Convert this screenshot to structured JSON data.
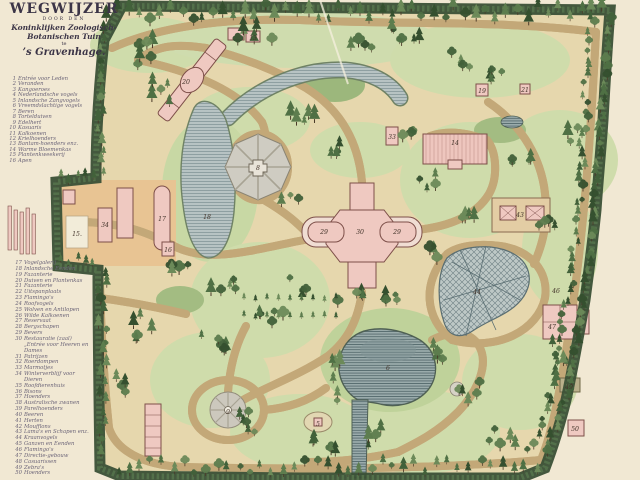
{
  "title": {
    "main": "WEGWIJZER",
    "sub": "DOOR DEN",
    "line3": "Koninklijken Zoologisch-",
    "line4": "Botanischen Tuin",
    "te": "te",
    "city": "’s Gravenhage."
  },
  "legend_top": [
    {
      "num": "1",
      "label": "Entrée voor Leden"
    },
    {
      "num": "2",
      "label": "Veranden"
    },
    {
      "num": "3",
      "label": "Kangoeroes"
    },
    {
      "num": "4",
      "label": "Nederlandsche vogels"
    },
    {
      "num": "5",
      "label": "Inlandsche Zangvogels"
    },
    {
      "num": "6",
      "label": "Vreemdslachtige vogels"
    },
    {
      "num": "7",
      "label": "Beren"
    },
    {
      "num": "8",
      "label": "Tortelduiven"
    },
    {
      "num": "9",
      "label": "Edelhert"
    },
    {
      "num": "10",
      "label": "Kasuaris"
    },
    {
      "num": "11",
      "label": "Kalkoenen"
    },
    {
      "num": "12",
      "label": "Krielhoenders"
    },
    {
      "num": "13",
      "label": "Bantam-hoenders enz."
    },
    {
      "num": "14",
      "label": "Warme Bloemenkas"
    },
    {
      "num": "15",
      "label": "Plantenkweekerij"
    },
    {
      "num": "16",
      "label": "Apen"
    }
  ],
  "legend_bottom": [
    {
      "num": "17",
      "label": "Vogelgalerij"
    },
    {
      "num": "18",
      "label": "Inlandsche Eenden"
    },
    {
      "num": "19",
      "label": "Fazanterie"
    },
    {
      "num": "20",
      "label": "Duiven en Plantenkas"
    },
    {
      "num": "21",
      "label": "Fazanterie"
    },
    {
      "num": "22",
      "label": "Uitspanplaats"
    },
    {
      "num": "23",
      "label": "Flamingo's"
    },
    {
      "num": "24",
      "label": "Roofvogels"
    },
    {
      "num": "25",
      "label": "Wolven en Antilopen"
    },
    {
      "num": "26",
      "label": "Wilde Kalkoenen"
    },
    {
      "num": "27",
      "label": "Reservaat"
    },
    {
      "num": "28",
      "label": "Bergschapen"
    },
    {
      "num": "29",
      "label": "Bevers"
    },
    {
      "num": "30",
      "label": "Restauratie (zaal) „Entrée voor Heeren en Dames"
    },
    {
      "num": "31",
      "label": "Patrijzen"
    },
    {
      "num": "32",
      "label": "Roerdompen"
    },
    {
      "num": "33",
      "label": "Marmotjes"
    },
    {
      "num": "34",
      "label": "Winterverblijf voor Dieren"
    },
    {
      "num": "35",
      "label": "Roofdierenhuis"
    },
    {
      "num": "36",
      "label": "Bisons"
    },
    {
      "num": "37",
      "label": "Hoenders"
    },
    {
      "num": "38",
      "label": "Australische zwanen"
    },
    {
      "num": "39",
      "label": "Parelhoenders"
    },
    {
      "num": "40",
      "label": "Beeren"
    },
    {
      "num": "41",
      "label": "Herten"
    },
    {
      "num": "42",
      "label": "Moufflons"
    },
    {
      "num": "43",
      "label": "Lama's en Schapen enz."
    },
    {
      "num": "44",
      "label": "Kraanvogels"
    },
    {
      "num": "45",
      "label": "Ganzen en Eenden"
    },
    {
      "num": "46",
      "label": "Flamingo's"
    },
    {
      "num": "47",
      "label": "Directie-gebouw"
    },
    {
      "num": "48",
      "label": "Casuarissen"
    },
    {
      "num": "49",
      "label": "Zebra's"
    },
    {
      "num": "50",
      "label": "Hoenders"
    }
  ],
  "map": {
    "markers": [
      {
        "label": "13",
        "x": 253,
        "y": 40
      },
      {
        "label": "20",
        "x": 186,
        "y": 84
      },
      {
        "label": "8",
        "x": 258,
        "y": 170
      },
      {
        "label": "18",
        "x": 207,
        "y": 219
      },
      {
        "label": "17",
        "x": 162,
        "y": 221
      },
      {
        "label": "16",
        "x": 168,
        "y": 252
      },
      {
        "label": "34",
        "x": 105,
        "y": 227
      },
      {
        "label": "15.",
        "x": 77,
        "y": 236
      },
      {
        "label": "14",
        "x": 455,
        "y": 145
      },
      {
        "label": "33",
        "x": 392,
        "y": 139
      },
      {
        "label": "19",
        "x": 482,
        "y": 93
      },
      {
        "label": "21",
        "x": 525,
        "y": 92
      },
      {
        "label": "29",
        "x": 324,
        "y": 234
      },
      {
        "label": "30",
        "x": 360,
        "y": 234
      },
      {
        "label": "29",
        "x": 397,
        "y": 234
      },
      {
        "label": "43",
        "x": 520,
        "y": 217
      },
      {
        "label": "44",
        "x": 477,
        "y": 294
      },
      {
        "label": "46",
        "x": 556,
        "y": 293
      },
      {
        "label": "47",
        "x": 552,
        "y": 329
      },
      {
        "label": "6",
        "x": 388,
        "y": 370
      },
      {
        "label": "5",
        "x": 318,
        "y": 426
      },
      {
        "label": "9",
        "x": 228,
        "y": 414
      },
      {
        "label": "49",
        "x": 569,
        "y": 389
      },
      {
        "label": "50",
        "x": 575,
        "y": 431
      }
    ]
  },
  "colors": {
    "paper": "#f1e8d3",
    "park": "#e6d7ad",
    "entrance": "#e8c493",
    "grass": "#cfdcab",
    "path_light": "#eedfae",
    "path_dark": "#c3a878",
    "water": "#b7c3c3",
    "water_dark": "#9aabab",
    "building": "#efc9c1",
    "building_stroke": "#7d4f49",
    "boundary": "#3a5036",
    "plaza": "#cfccc2",
    "ink": "#43342a",
    "legend_ink": "#6b6478",
    "title_ink": "#3c3547"
  }
}
